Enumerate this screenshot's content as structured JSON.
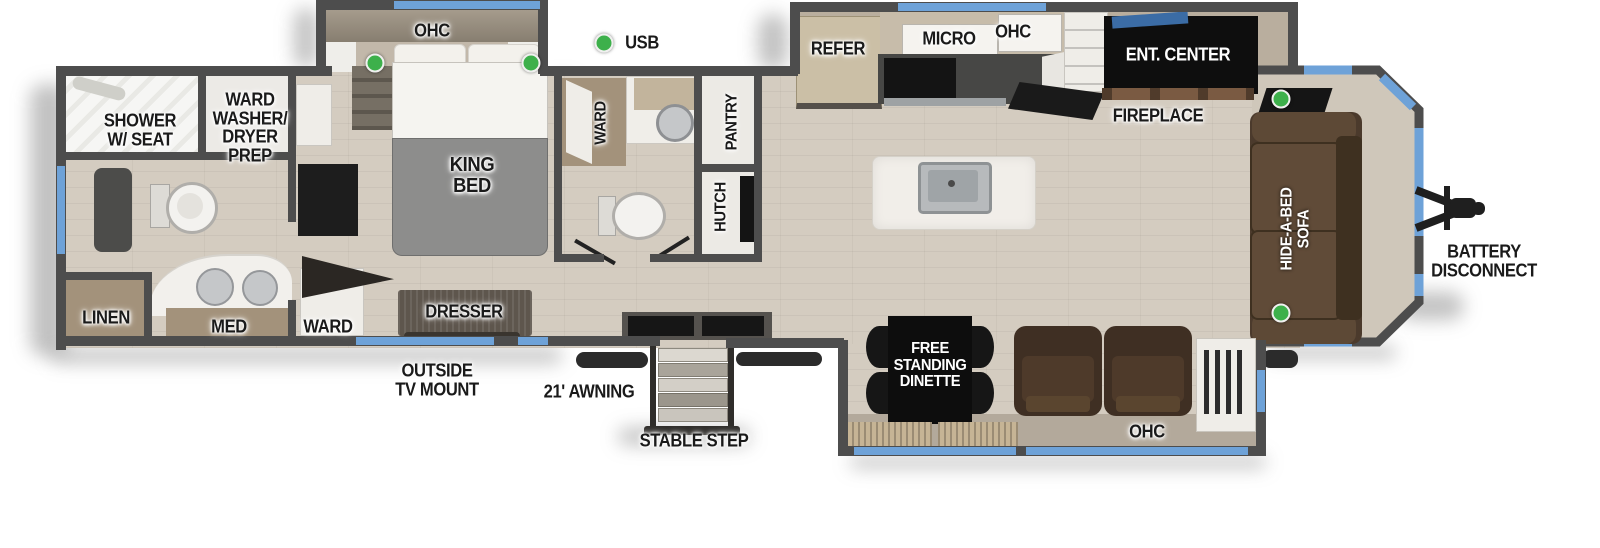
{
  "scene": {
    "width": 1600,
    "height": 548,
    "background": "#ffffff"
  },
  "legend": {
    "usb_label": "USB"
  },
  "colors": {
    "wall": "#4d4d4d",
    "window_blue": "#6ea2d8",
    "usb_green": "#3db04b",
    "floor": "#d4ccc0",
    "cap_beige": "#cfc7ba",
    "label_ink": "#1a1a1a",
    "black_box": "#0e0e0e"
  },
  "labels": {
    "ohc_bedroom": "OHC",
    "shower": "SHOWER\nW/ SEAT",
    "ward_washer_dryer_prep": "WARD\nWASHER/\nDRYER\nPREP",
    "king_bed": "KING\nBED",
    "ward_bath": "WARD",
    "pantry": "PANTRY",
    "hutch": "HUTCH",
    "refer": "REFER",
    "micro": "MICRO",
    "ohc_kitchen": "OHC",
    "ent_center": "ENT. CENTER",
    "fireplace": "FIREPLACE",
    "hide_a_bed_sofa": "HIDE-A-BED\nSOFA",
    "battery_disconnect": "BATTERY\nDISCONNECT",
    "linen": "LINEN",
    "med": "MED",
    "ward_bedroom": "WARD",
    "dresser": "DRESSER",
    "outside_tv_mount": "OUTSIDE\nTV MOUNT",
    "awning": "21' AWNING",
    "stable_step": "STABLE STEP",
    "free_standing_dinette": "FREE\nSTANDING\nDINETTE",
    "ohc_dinette": "OHC"
  }
}
